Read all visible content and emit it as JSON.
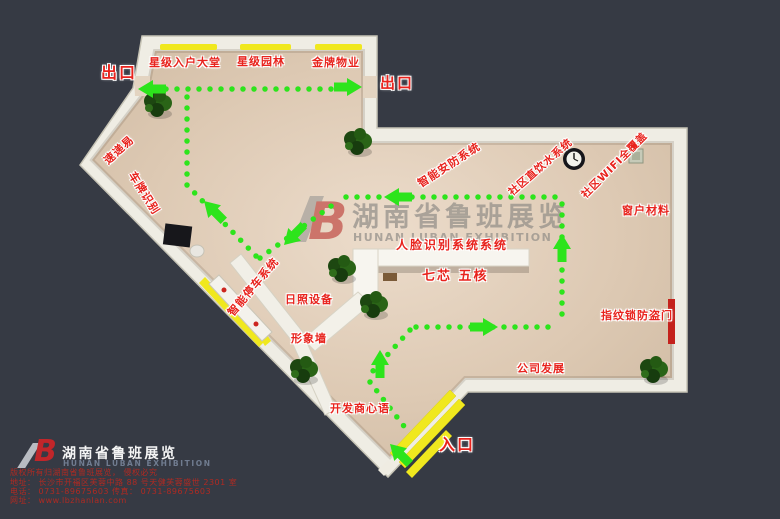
{
  "title": "湖南省鲁班展览展位平面图",
  "colors": {
    "background": "#363a44",
    "wall": "#efede4",
    "floor": "#dcc9b3",
    "path_green": "#2de41c",
    "label_red": "#e8231d",
    "door_yellow": "#f0e81e",
    "footer_red": "#b02a22"
  },
  "labels": {
    "exit_left": "出口",
    "exit_right": "出口",
    "entrance": "入口",
    "lobby": "星级入户大堂",
    "garden": "星级园林",
    "property": "金牌物业",
    "express": "速递易",
    "plate_recognition": "车牌识别",
    "security": "智能安防系统",
    "drinking_water": "社区直饮水系统",
    "wifi": "社区WIFI全覆盖",
    "window_material": "窗户材料",
    "face_recognition": "人脸识别系统系统",
    "seven_core": "七芯 五核",
    "smart_parking": "智能停车系统",
    "sunshine_device": "日照设备",
    "image_wall": "形象墙",
    "developer_words": "开发商心语",
    "company_growth": "公司发展",
    "fingerprint_lock": "指纹锁防盗门"
  },
  "watermark": {
    "logo": "B",
    "cn": "湖南省鲁班展览",
    "en": "HUNAN  LUBAN  EXHIBITION"
  },
  "footer": {
    "logo": "B",
    "company_cn": "湖南省鲁班展览",
    "company_en": "HUNAN LUBAN EXHIBITION",
    "copyright": "版权所有归湖南省鲁班展览， 侵权必究",
    "address": "地址： 长沙市开福区芙蓉中路 88 号天健芙蓉盛世 2301 室",
    "phone_fax": "电话： 0731-89675603    传真： 0731-89675603",
    "website": "网址： www.lbzhanlan.com"
  }
}
